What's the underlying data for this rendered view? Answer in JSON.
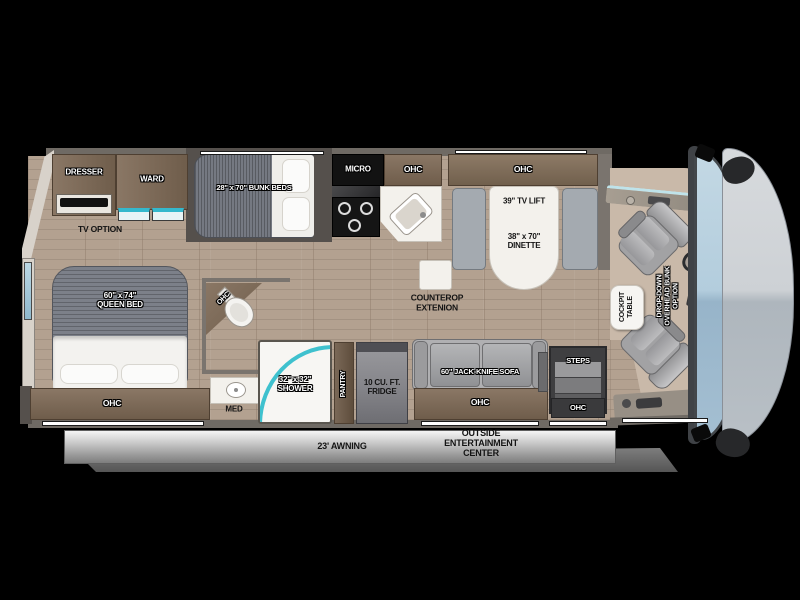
{
  "page": {
    "description": "RV motorhome top-view floor plan on black background"
  },
  "colors": {
    "background": "#000000",
    "floor_wood": "#b3a190",
    "cabinet_brown": "#7c6a58",
    "wall_gray": "#6f6a64",
    "accent_teal": "#3fc1ce",
    "seat_gray": "#a2a2a4",
    "awning_gray": "#c9c9c9",
    "front_cap_gray": "#c8ccd0",
    "windshield_blue": "#a9c4d6"
  },
  "labels": {
    "dresser": "DRESSER",
    "ward": "WARD",
    "bunk_beds": "28\" x 70\" BUNK BEDS",
    "tv_option": "TV OPTION",
    "micro": "MICRO",
    "ohc": "OHC",
    "tv_lift": "39\" TV LIFT",
    "dinette": "38\" x 70\"\nDINETTE",
    "queen_bed": "60\" x 74\"\nQUEEN BED",
    "med": "MED",
    "shower": "32\" x 32\"\nSHOWER",
    "pantry": "PANTRY",
    "fridge": "10 CU. FT.\nFRIDGE",
    "countertop_extension": "COUNTEROP\nEXTENION",
    "sofa": "60\" JACK-KNIFE SOFA",
    "steps": "STEPS",
    "cockpit_table": "COCKPIT\nTABLE",
    "overhead_bunk_option": "DROP-DOWN\nOVERHEAD BUNK\nOPTION",
    "awning": "23' AWNING",
    "outside_entertainment": "OUTSIDE\nENTERTAINMENT\nCENTER"
  }
}
